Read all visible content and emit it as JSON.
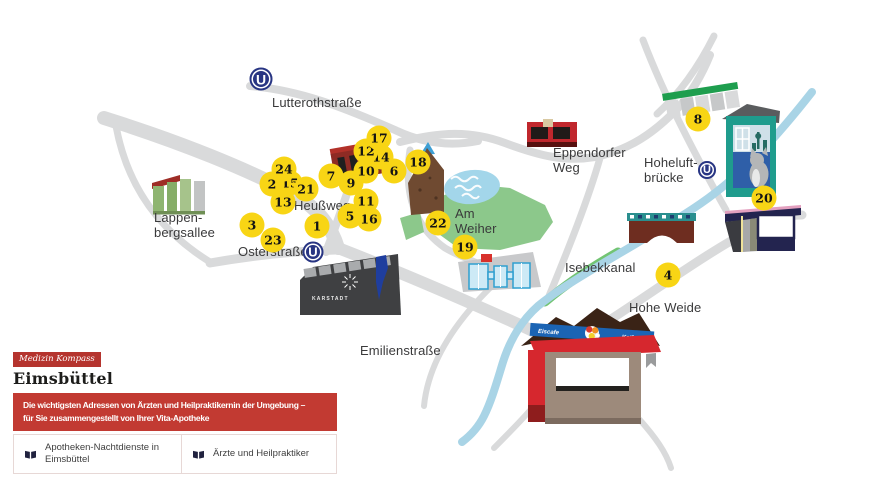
{
  "panel": {
    "tag": "Medizin Kompass",
    "title": "Eimsbüttel",
    "banner": "Die wichtigsten Adressen von Ärzten und Heilpraktikernin der Umgebung –\nfür Sie zusammengestellt von Ihrer Vita-Apotheke",
    "legend": [
      {
        "icon": "book-icon",
        "label": "Apotheken-Nachtdienste in Eimsbüttel"
      },
      {
        "icon": "book-icon",
        "label": "Ärzte und Heilpraktiker"
      }
    ]
  },
  "map": {
    "street_labels": [
      {
        "name": "lutterothstrasse",
        "text": "Lutterothstraße",
        "x": 272,
        "y": 95
      },
      {
        "name": "heussweg",
        "text": "Heußweg",
        "x": 294,
        "y": 198
      },
      {
        "name": "osterstrasse",
        "text": "Osterstraße",
        "x": 238,
        "y": 244
      },
      {
        "name": "lappenbergsallee",
        "text": "Lappen-\nbergsallee",
        "x": 154,
        "y": 210
      },
      {
        "name": "emilienstrasse",
        "text": "Emilienstraße",
        "x": 360,
        "y": 343
      },
      {
        "name": "eppendorfer-weg",
        "text": "Eppendorfer\nWeg",
        "x": 553,
        "y": 145
      },
      {
        "name": "hoheluftbruecke",
        "text": "Hoheluft-\nbrücke",
        "x": 644,
        "y": 155
      },
      {
        "name": "am-weiher",
        "text": "Am\nWeiher",
        "x": 455,
        "y": 206
      },
      {
        "name": "isebekkanal",
        "text": "Isebekkanal",
        "x": 565,
        "y": 260
      },
      {
        "name": "hohe-weide",
        "text": "Hohe Weide",
        "x": 629,
        "y": 300
      }
    ],
    "markers": [
      {
        "n": "1",
        "x": 317,
        "y": 226
      },
      {
        "n": "2",
        "x": 272,
        "y": 184,
        "z": 2
      },
      {
        "n": "3",
        "x": 252,
        "y": 225
      },
      {
        "n": "4",
        "x": 668,
        "y": 275
      },
      {
        "n": "5",
        "x": 350,
        "y": 216,
        "z": 2
      },
      {
        "n": "6",
        "x": 394,
        "y": 171
      },
      {
        "n": "7",
        "x": 331,
        "y": 176
      },
      {
        "n": "8",
        "x": 698,
        "y": 119
      },
      {
        "n": "9",
        "x": 351,
        "y": 183
      },
      {
        "n": "10",
        "x": 366,
        "y": 171
      },
      {
        "n": "11",
        "x": 366,
        "y": 201
      },
      {
        "n": "12",
        "x": 366,
        "y": 151,
        "z": 2
      },
      {
        "n": "13",
        "x": 283,
        "y": 202
      },
      {
        "n": "14",
        "x": 381,
        "y": 157
      },
      {
        "n": "15",
        "x": 290,
        "y": 183
      },
      {
        "n": "16",
        "x": 369,
        "y": 219
      },
      {
        "n": "17",
        "x": 379,
        "y": 138,
        "z": 3
      },
      {
        "n": "18",
        "x": 418,
        "y": 162
      },
      {
        "n": "19",
        "x": 465,
        "y": 247
      },
      {
        "n": "20",
        "x": 764,
        "y": 198
      },
      {
        "n": "21",
        "x": 306,
        "y": 189
      },
      {
        "n": "22",
        "x": 438,
        "y": 223
      },
      {
        "n": "23",
        "x": 273,
        "y": 240
      },
      {
        "n": "24",
        "x": 284,
        "y": 169,
        "z": 2
      }
    ],
    "ubahn_stations": [
      {
        "label": "U",
        "x": 261,
        "y": 79,
        "d": 23
      },
      {
        "label": "U",
        "x": 313,
        "y": 252,
        "d": 21
      },
      {
        "label": "U",
        "x": 707,
        "y": 170,
        "d": 18
      }
    ],
    "building_signs": {
      "karstadt": "KARSTADT",
      "kiosk_left": "Eiscafe",
      "kiosk_right": "Kaifu"
    }
  },
  "colors": {
    "accent_red": "#c23a32",
    "marker_yellow": "#f8d515",
    "ubahn_blue": "#283583",
    "road_gray": "#d9dadb",
    "water_blue": "#a9d4e6",
    "park_green": "#8cc88b"
  }
}
